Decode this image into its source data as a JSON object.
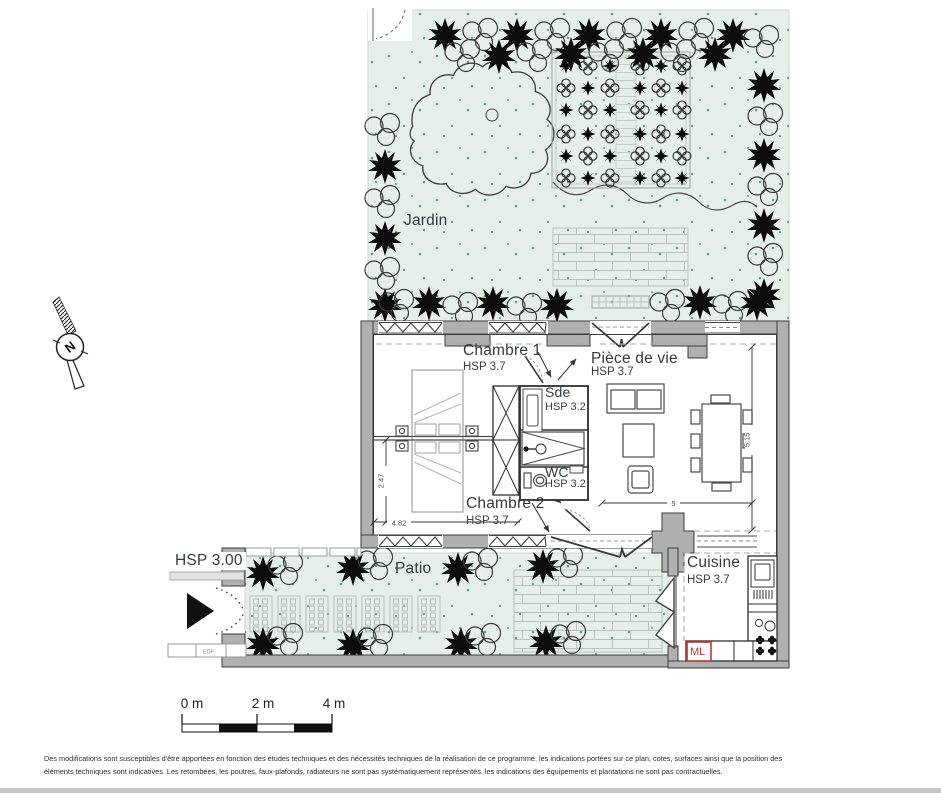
{
  "plan": {
    "rooms": {
      "jardin": {
        "label": "Jardin"
      },
      "chambre1": {
        "label": "Chambre 1",
        "hsp": "HSP 3.7"
      },
      "piece_de_vie": {
        "label": "Pièce de vie",
        "hsp": "HSP 3.7"
      },
      "sde": {
        "label": "Sde",
        "hsp": "HSP 3.2"
      },
      "wc": {
        "label": "WC",
        "hsp": "HSP 3.2"
      },
      "chambre2": {
        "label": "Chambre 2",
        "hsp": "HSP 3.7"
      },
      "patio": {
        "label": "Patio"
      },
      "cuisine": {
        "label": "Cuisine",
        "hsp": "HSP 3.7"
      }
    },
    "annotations": {
      "entrance_hsp": "HSP 3.00",
      "edf": "EDF",
      "ml": "ML",
      "north": "N"
    },
    "dimensions": {
      "bedroom_depth": "2.47",
      "bedroom_width": "4.82",
      "living_depth": "5.15",
      "living_width": "5"
    },
    "scale_bar": {
      "zero": "0 m",
      "two": "2 m",
      "four": "4 m"
    },
    "disclaimer": {
      "line1": "Des modifications sont susceptibles d'être apportées en fonction des études techniques et des nécessités techniques de la réalisation de ce programme. les indications portées sur ce plan, cotes, surfaces ainsi que la position des",
      "line2": "éléments techniques sont indicatives. Les retombées, les poutres, faux-plafonds, radiateurs ne sont pas systématiquement représentés. les indications des équipements et plantations ne sont pas contractuelles."
    },
    "colors": {
      "outdoor": "#e6eeea",
      "wall": "#b0b0b0",
      "accent_red": "#c9342c",
      "grass": "#3f9e4a"
    }
  }
}
